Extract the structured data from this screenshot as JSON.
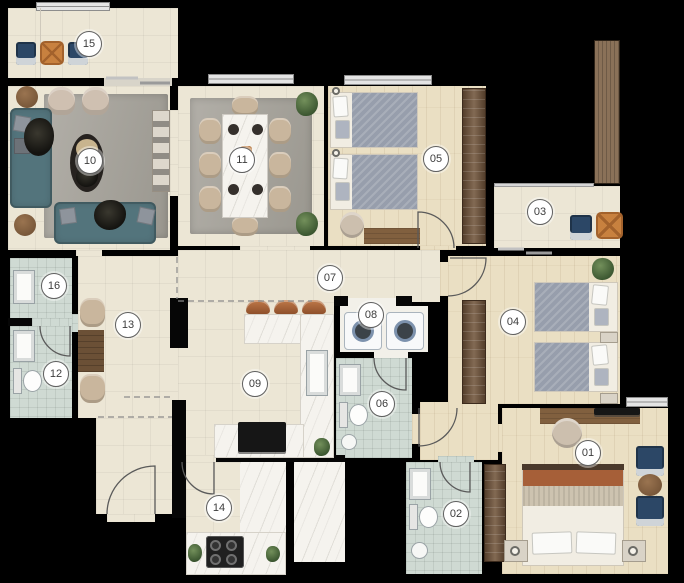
{
  "rooms": [
    {
      "number": "01"
    },
    {
      "number": "02"
    },
    {
      "number": "03"
    },
    {
      "number": "04"
    },
    {
      "number": "05"
    },
    {
      "number": "06"
    },
    {
      "number": "07"
    },
    {
      "number": "08"
    },
    {
      "number": "09"
    },
    {
      "number": "10"
    },
    {
      "number": "11"
    },
    {
      "number": "12"
    },
    {
      "number": "13"
    },
    {
      "number": "14"
    },
    {
      "number": "15"
    },
    {
      "number": "16"
    }
  ],
  "colors": {
    "background": "#000000",
    "walls": "#060606",
    "tile_floor": "#ece6d5",
    "wood_floor": "#eadfc3",
    "bathroom_tile": "#cfdad3",
    "marble": "#f5f3ee",
    "rug_gray": "#a5a29b",
    "sofa_teal": "#53747c",
    "armchair_beige": "#cfc0b1",
    "lounge_chair_blue": "#2c4766",
    "side_table_orange": "#c8813f",
    "wood_dark": "#6e5137",
    "copper_stool": "#c07a49",
    "bed_blanket_gray": "#979eac",
    "bed_accent_sienna": "#a65f38",
    "plant_green": "#4c6b3e",
    "label_background": "#ffffff",
    "label_border": "#5f5f5f"
  }
}
